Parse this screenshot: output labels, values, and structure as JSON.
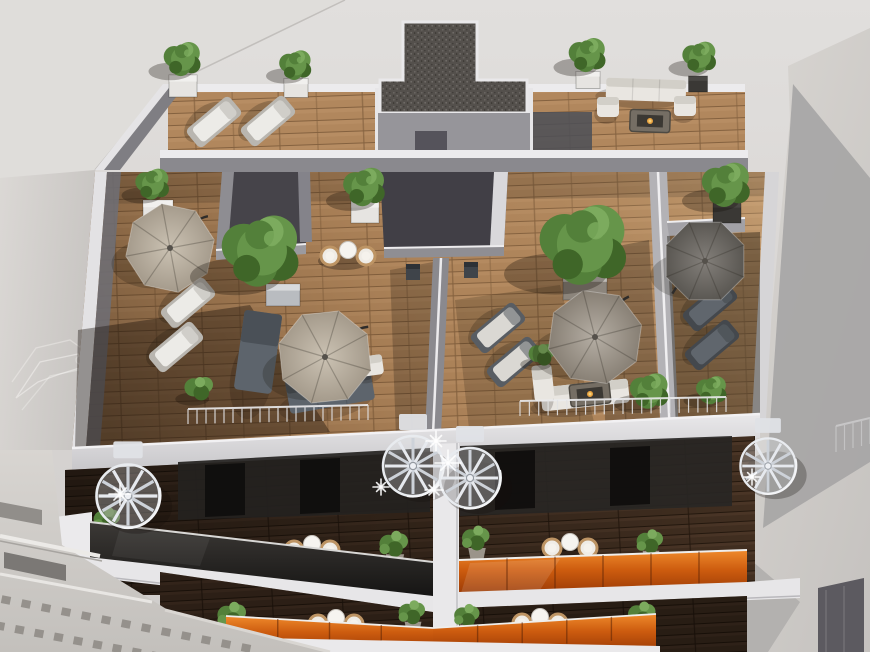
{
  "scene": {
    "subject": "aerial-3d-render-rooftop-terraces",
    "palette": {
      "sky_top": "#e0dedc",
      "sky_bottom": "#d0cdca",
      "neighbor_roof": "#dfddda",
      "neighbor_wall": "#d6d3d0",
      "neighbor_shadow": "#a8a7a6",
      "neighbor_shadow2": "#b3b1af",
      "wall_lit": "#a3a2a5",
      "wall_mid": "#8d8c90",
      "wall_shade": "#737277",
      "wall_dark": "#55535b",
      "parapet_white": "#e9e8ea",
      "parapet_shade": "#cfced2",
      "wood_lit": "#b1875d",
      "wood_joint": "#84613f",
      "wood_dark": "#4a3525",
      "wood_dark_joint": "#2a1c10",
      "gravel_base": "#54504c",
      "gravel_dot_light": "#6a6662",
      "gravel_dot_dark": "#403d3a",
      "green_dark": "#3f6628",
      "green_mid": "#53803a",
      "green_light": "#66954a",
      "green_hi": "#7cab5e",
      "parasol_beige": "#b7aea1",
      "parasol_taupe": "#a29b91",
      "parasol_dark": "#6b6864",
      "orange_glass": "#cd5c0f",
      "orange_glass_light": "#ef8a2c",
      "orange_glass_dark": "#9a3a05",
      "charcoal_glass": "#2b2927",
      "stair_metal": "#e4e7ec",
      "stair_shade": "#b9bfc8",
      "furniture_white": "#e9e6e1",
      "furniture_slate": "#5d646c",
      "rattan": "#bd9464",
      "sparkle": "#ffffff"
    }
  },
  "roof": {
    "trees": [
      {
        "x": 153,
        "y": 185,
        "r": 21
      },
      {
        "x": 183,
        "y": 60,
        "r": 23
      },
      {
        "x": 296,
        "y": 66,
        "r": 20
      },
      {
        "x": 588,
        "y": 56,
        "r": 23
      },
      {
        "x": 700,
        "y": 58,
        "r": 21
      },
      {
        "x": 262,
        "y": 253,
        "r": 48
      },
      {
        "x": 585,
        "y": 247,
        "r": 54
      },
      {
        "x": 365,
        "y": 188,
        "r": 26
      },
      {
        "x": 727,
        "y": 186,
        "r": 30
      },
      {
        "x": 650,
        "y": 392,
        "r": 24
      },
      {
        "x": 712,
        "y": 391,
        "r": 19
      }
    ],
    "pots": [
      {
        "x": 158,
        "y": 212,
        "w": 30,
        "h": 24,
        "tone": "white"
      },
      {
        "x": 183,
        "y": 86,
        "w": 28,
        "h": 22,
        "tone": "white"
      },
      {
        "x": 296,
        "y": 88,
        "w": 24,
        "h": 19,
        "tone": "white"
      },
      {
        "x": 365,
        "y": 212,
        "w": 28,
        "h": 22,
        "tone": "white"
      },
      {
        "x": 588,
        "y": 80,
        "w": 24,
        "h": 17,
        "tone": "white"
      },
      {
        "x": 698,
        "y": 84,
        "w": 19,
        "h": 16,
        "tone": "dark"
      },
      {
        "x": 727,
        "y": 212,
        "w": 28,
        "h": 22,
        "tone": "dark"
      },
      {
        "x": 283,
        "y": 295,
        "w": 34,
        "h": 22,
        "tone": "silver"
      },
      {
        "x": 585,
        "y": 287,
        "w": 44,
        "h": 26,
        "tone": "timber"
      }
    ],
    "parasols": [
      {
        "x": 170,
        "y": 248,
        "r": 45,
        "tone": "beige",
        "rot": 12,
        "arm": 40
      },
      {
        "x": 325,
        "y": 357,
        "r": 48,
        "tone": "beige",
        "rot": -6,
        "arm": 35
      },
      {
        "x": 595,
        "y": 337,
        "r": 48,
        "tone": "taupe",
        "rot": 8,
        "arm": 50
      },
      {
        "x": 705,
        "y": 261,
        "r": 42,
        "tone": "dark",
        "rot": 0,
        "arm": 225
      }
    ],
    "loungers": [
      {
        "x": 214,
        "y": 122,
        "rot": 50,
        "tone": "white"
      },
      {
        "x": 268,
        "y": 121,
        "rot": 50,
        "tone": "white"
      },
      {
        "x": 188,
        "y": 303,
        "rot": 50,
        "tone": "white"
      },
      {
        "x": 176,
        "y": 347,
        "rot": 50,
        "tone": "white"
      },
      {
        "x": 498,
        "y": 328,
        "rot": 50,
        "tone": "duo"
      },
      {
        "x": 514,
        "y": 362,
        "rot": 50,
        "tone": "duo"
      },
      {
        "x": 710,
        "y": 306,
        "rot": 50,
        "tone": "dark"
      },
      {
        "x": 712,
        "y": 345,
        "rot": 50,
        "tone": "dark"
      }
    ],
    "sofas": [
      {
        "x": 646,
        "y": 90,
        "w": 80,
        "h": 22,
        "rot": 2,
        "tone": "white"
      },
      {
        "x": 608,
        "y": 107,
        "w": 22,
        "h": 20,
        "rot": 0,
        "tone": "white"
      },
      {
        "x": 685,
        "y": 106,
        "w": 22,
        "h": 20,
        "rot": 0,
        "tone": "white"
      },
      {
        "x": 258,
        "y": 352,
        "w": 38,
        "h": 80,
        "rot": 8,
        "tone": "slate"
      },
      {
        "x": 330,
        "y": 390,
        "w": 86,
        "h": 34,
        "rot": -10,
        "tone": "slate"
      },
      {
        "x": 368,
        "y": 366,
        "w": 30,
        "h": 20,
        "rot": -8,
        "tone": "white"
      },
      {
        "x": 585,
        "y": 395,
        "w": 88,
        "h": 24,
        "rot": -6,
        "tone": "white"
      },
      {
        "x": 543,
        "y": 383,
        "w": 20,
        "h": 36,
        "rot": -6,
        "tone": "white"
      }
    ],
    "fire_tables": [
      {
        "x": 650,
        "y": 121,
        "rot": 2
      },
      {
        "x": 590,
        "y": 394,
        "rot": -6
      }
    ],
    "bistro_sets": [
      {
        "x": 348,
        "y": 253
      }
    ],
    "chairs": [
      {
        "x": 413,
        "y": 272
      },
      {
        "x": 471,
        "y": 270
      }
    ],
    "shrubs": [
      {
        "x": 200,
        "y": 390,
        "s": 1.3
      },
      {
        "x": 543,
        "y": 356,
        "s": 1.2
      }
    ]
  },
  "stairs": [
    {
      "x": 128,
      "y": 496,
      "s": 1.05
    },
    {
      "x": 413,
      "y": 466,
      "s": 1.0
    },
    {
      "x": 470,
      "y": 478,
      "s": 1.0
    },
    {
      "x": 768,
      "y": 466,
      "s": 0.92
    }
  ],
  "sparkles": [
    {
      "x": 436,
      "y": 441,
      "s": 10
    },
    {
      "x": 448,
      "y": 463,
      "s": 13
    },
    {
      "x": 434,
      "y": 490,
      "s": 9
    },
    {
      "x": 381,
      "y": 487,
      "s": 8
    },
    {
      "x": 120,
      "y": 494,
      "s": 11
    },
    {
      "x": 752,
      "y": 477,
      "s": 8
    }
  ],
  "balcony_upper": {
    "bistro_sets": [
      {
        "x": 312,
        "y": 547
      },
      {
        "x": 570,
        "y": 545
      }
    ],
    "plants": [
      {
        "x": 108,
        "y": 524,
        "s": 1.2
      },
      {
        "x": 395,
        "y": 549,
        "s": 1.3
      },
      {
        "x": 477,
        "y": 543,
        "s": 1.25
      },
      {
        "x": 651,
        "y": 546,
        "s": 1.2
      }
    ]
  },
  "balcony_lower": {
    "bistro_sets": [
      {
        "x": 336,
        "y": 621
      },
      {
        "x": 540,
        "y": 620
      }
    ],
    "plants": [
      {
        "x": 233,
        "y": 620,
        "s": 1.3
      },
      {
        "x": 413,
        "y": 617,
        "s": 1.2
      },
      {
        "x": 468,
        "y": 620,
        "s": 1.15
      },
      {
        "x": 643,
        "y": 619,
        "s": 1.25
      },
      {
        "x": 283,
        "y": 636,
        "s": 1.0
      }
    ]
  },
  "railings": [
    {
      "x1": 188,
      "y1": 424,
      "x2": 368,
      "y2": 420,
      "h": 15,
      "n": 20,
      "op": 0.9
    },
    {
      "x1": 520,
      "y1": 416,
      "x2": 726,
      "y2": 412,
      "h": 15,
      "n": 22,
      "op": 0.9
    },
    {
      "x1": 836,
      "y1": 452,
      "x2": 870,
      "y2": 444,
      "h": 26,
      "n": 4,
      "op": 0.45
    }
  ],
  "glass_dividers": {
    "upper": {
      "x1": 459,
      "yt1": 560,
      "x2": 747,
      "yt2": 550,
      "hb": 34,
      "n": 6
    },
    "lower_left": {
      "x1": 226,
      "yt1": 616,
      "x2": 433,
      "yt2": 628,
      "hb": 24,
      "n": 4
    },
    "lower_right": {
      "x1": 433,
      "yt1": 628,
      "x2": 656,
      "yt2": 614,
      "hb": 24,
      "n": 5
    }
  },
  "dentil_rows": [
    {
      "x1": 6,
      "y1": 600,
      "x2": 246,
      "y2": 648,
      "n": 13
    },
    {
      "x1": 0,
      "y1": 626,
      "x2": 156,
      "y2": 656,
      "n": 9
    }
  ]
}
